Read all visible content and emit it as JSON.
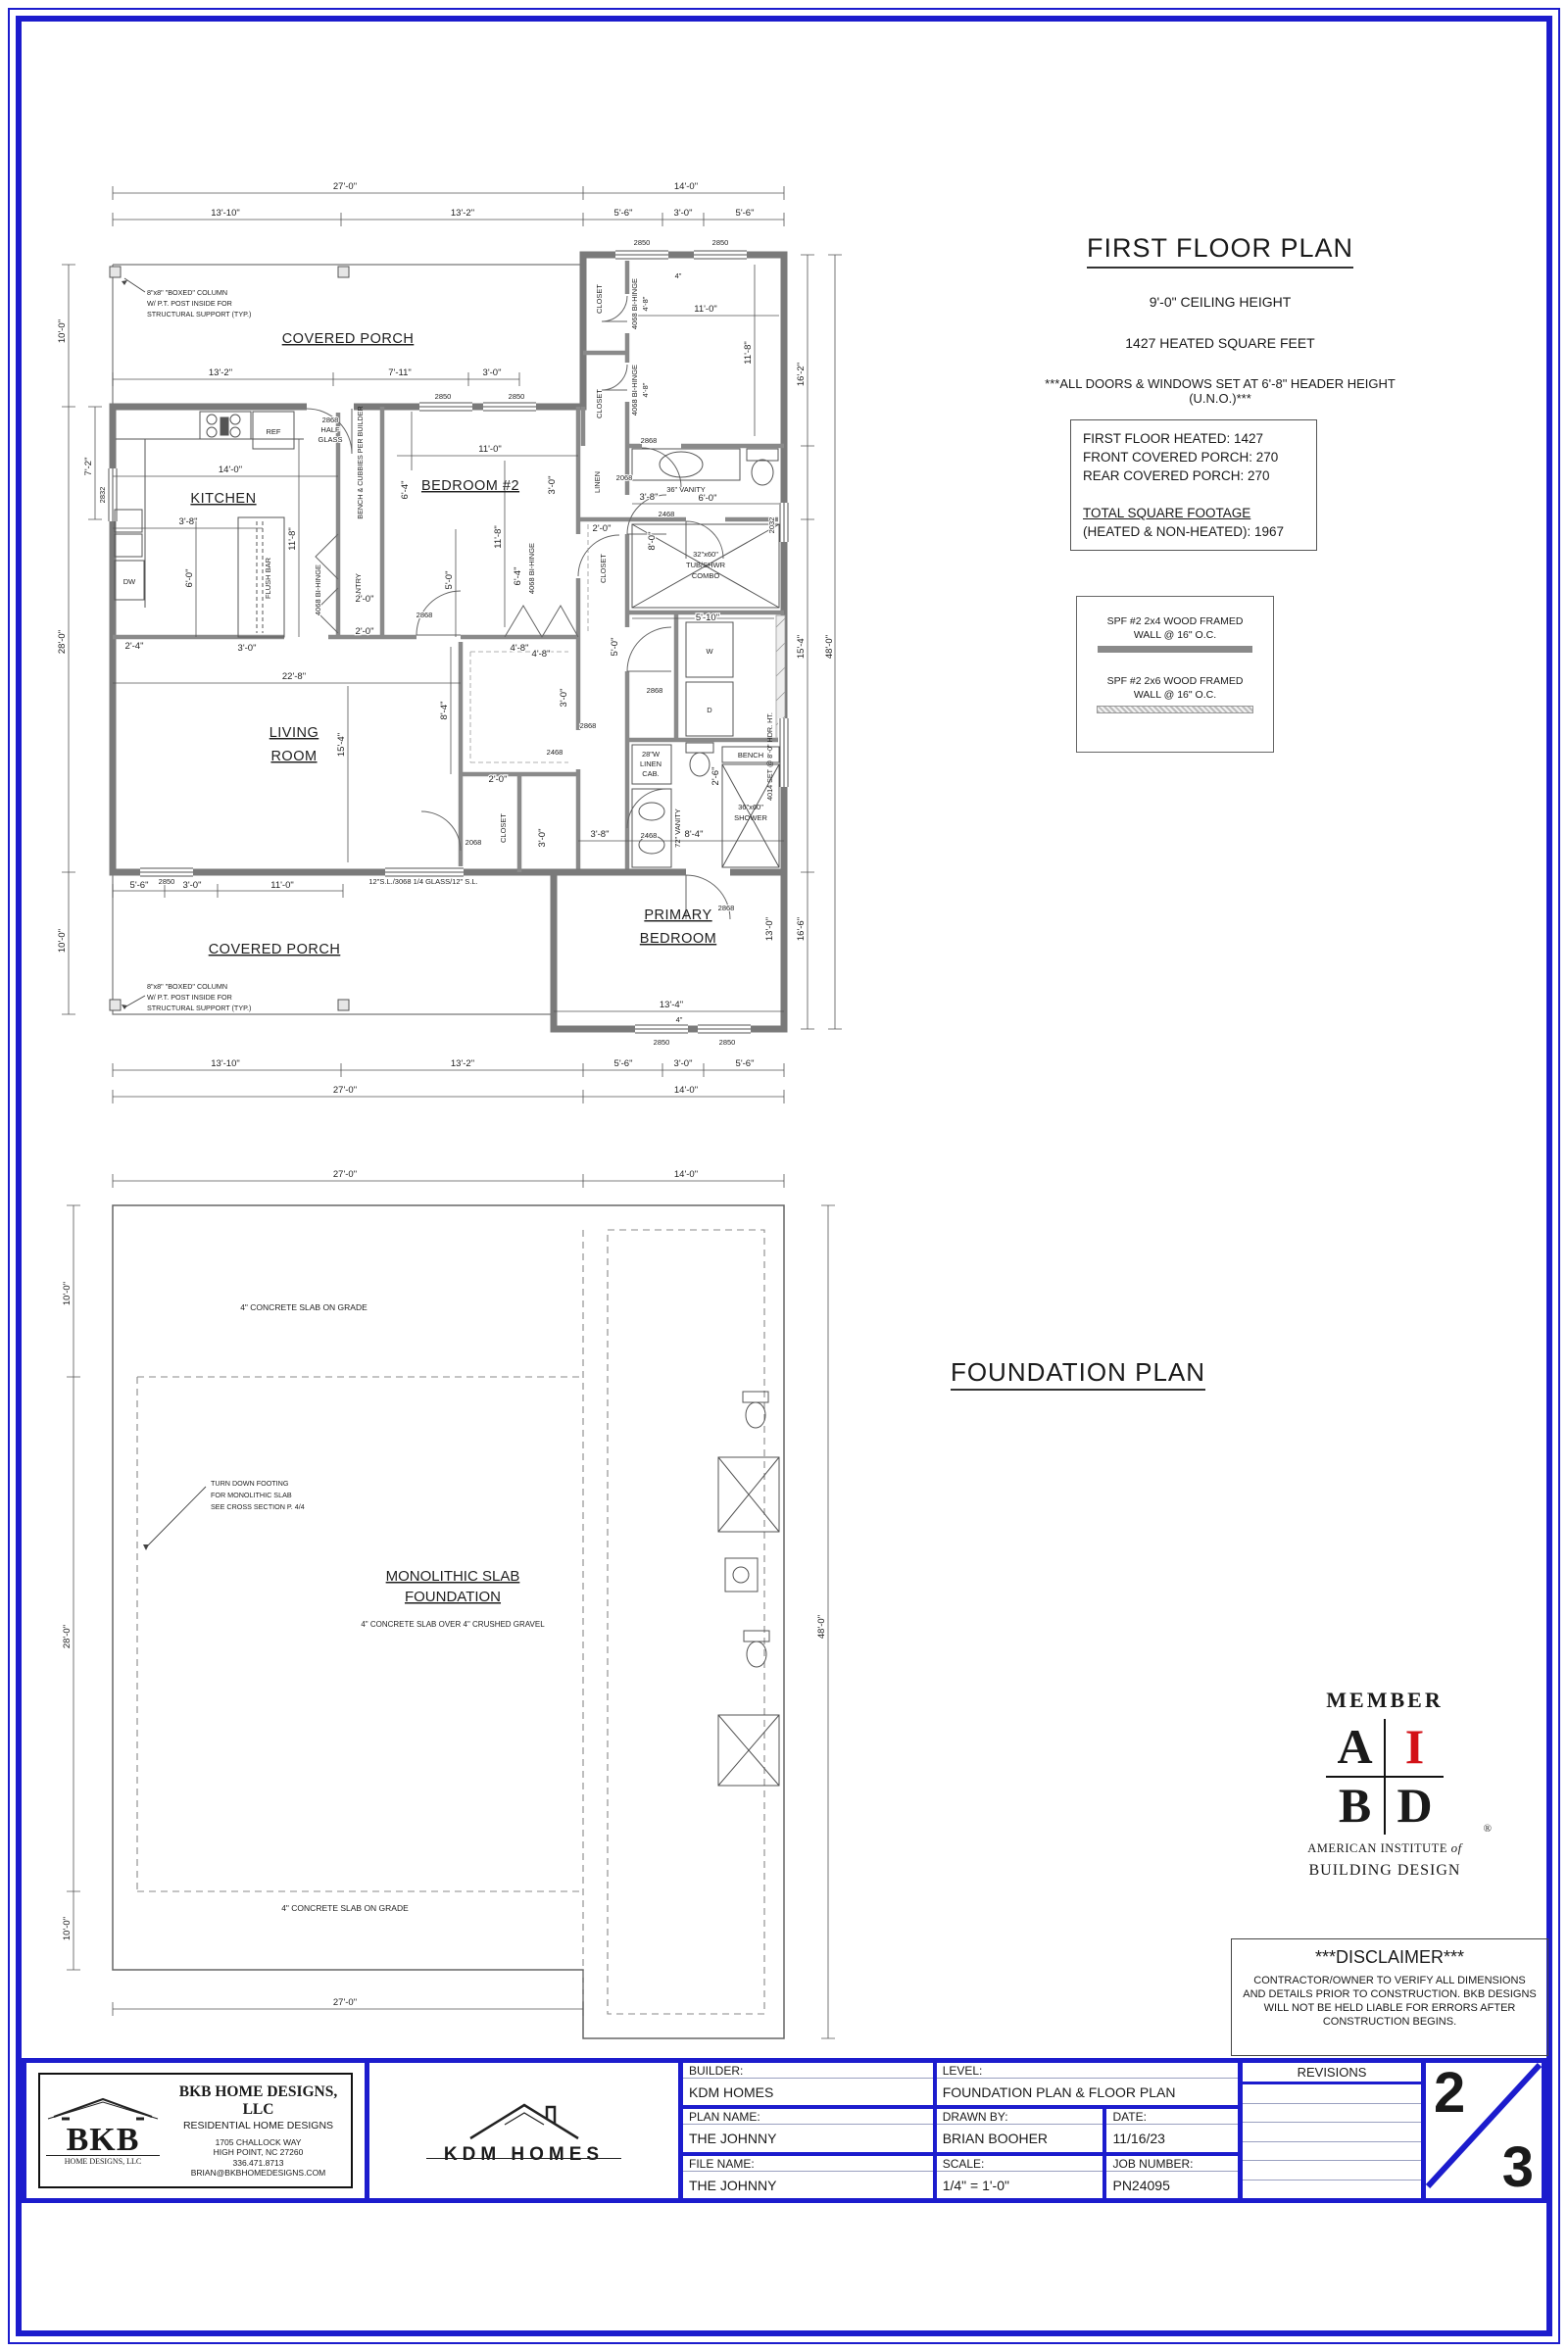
{
  "colors": {
    "border_blue": "#1c1ccd",
    "aibd_red": "#d31117",
    "wall_gray": "#7a7a7a"
  },
  "dims": {
    "d4": "4\"",
    "d2_0": "2'-0\"",
    "d2_4": "2'-4\"",
    "d2_6": "2'-6\"",
    "d3_0": "3'-0\"",
    "d3_8": "3'-8\"",
    "d4_8": "4'-8\"",
    "d5_0": "5'-0\"",
    "d5_6": "5'-6\"",
    "d5_10": "5'-10\"",
    "d6_0": "6'-0\"",
    "d6_4": "6'-4\"",
    "d7_2": "7'-2\"",
    "d7_11": "7'-11\"",
    "d8_0": "8'-0\"",
    "d8_4": "8'-4\"",
    "d10_0": "10'-0\"",
    "d11_0": "11'-0\"",
    "d11_8": "11'-8\"",
    "d13_0": "13'-0\"",
    "d13_2": "13'-2\"",
    "d13_4": "13'-4\"",
    "d13_10": "13'-10\"",
    "d14_0": "14'-0\"",
    "d15_4": "15'-4\"",
    "d16_2": "16'-2\"",
    "d16_6": "16'-6\"",
    "d22_8": "22'-8\"",
    "d27_0": "27'-0\"",
    "d28_0": "28'-0\"",
    "d48_0": "48'-0\""
  },
  "tags": {
    "w2850": "2850",
    "w2832": "2832",
    "w2032": "2032",
    "d2868": "2868",
    "d2068": "2068",
    "d2468": "2468",
    "bihinge": "4068 BI-HINGE",
    "hg1": "2868",
    "hg2": "HALF",
    "hg3": "GLASS",
    "slider": "12\"S.L./3068 1/4 GLASS/12\" S.L.",
    "w4014": "4014 SET @ 8'-0\" HDR. HT."
  },
  "rooms": {
    "covered_porch": "COVERED PORCH",
    "kitchen": "KITCHEN",
    "bedroom2": "BEDROOM #2",
    "living1": "LIVING",
    "living2": "ROOM",
    "primary1": "PRIMARY",
    "primary2": "BEDROOM"
  },
  "fx": {
    "ref": "REF",
    "dw": "DW",
    "flush": "FLUSH BAR",
    "pantry": "PANTRY",
    "linen": "LINEN",
    "closet": "CLOSET",
    "bench_cub": "BENCH & CUBBIES PER BUILDER",
    "v36": "36\" VANITY",
    "v72": "72\" VANITY",
    "tub1": "32\"x60\"",
    "tub2": "TUB/SHWR",
    "tub3": "COMBO",
    "sh1": "36\"x60\"",
    "sh2": "SHOWER",
    "bench": "BENCH",
    "lc1": "28\"W",
    "lc2": "LINEN",
    "lc3": "CAB.",
    "w": "W",
    "d": "D"
  },
  "notes": {
    "col1": "8\"x8\" \"BOXED\" COLUMN",
    "col2": "W/ P.T. POST INSIDE FOR",
    "col3": "STRUCTURAL SUPPORT (TYP.)"
  },
  "ffh": {
    "title": "FIRST FLOOR PLAN",
    "ceiling": "9'-0\" CEILING HEIGHT",
    "sqft": "1427 HEATED SQUARE FEET",
    "header": "***ALL DOORS & WINDOWS SET AT 6'-8\" HEADER HEIGHT (U.N.O.)***",
    "a1": "FIRST FLOOR HEATED: 1427",
    "a2": "FRONT COVERED PORCH: 270",
    "a3": "REAR COVERED PORCH: 270",
    "t1": "TOTAL SQUARE FOOTAGE",
    "t2": "(HEATED & NON-HEATED): 1967",
    "l1a": "SPF #2 2x4 WOOD FRAMED",
    "l1b": "WALL @ 16\" O.C.",
    "l2a": "SPF #2 2x6 WOOD FRAMED",
    "l2b": "WALL @ 16\" O.C."
  },
  "fp": {
    "heading": "FOUNDATION PLAN",
    "m1": "MONOLITHIC SLAB",
    "m2": "FOUNDATION",
    "m3": "4\" CONCRETE SLAB OVER 4\" CRUSHED GRAVEL",
    "slab": "4\" CONCRETE SLAB ON GRADE",
    "t1": "TURN DOWN FOOTING",
    "t2": "FOR MONOLITHIC SLAB",
    "t3": "SEE CROSS SECTION P. 4/4"
  },
  "aibd": {
    "member": "MEMBER",
    "a": "A",
    "i": "I",
    "b": "B",
    "d": "D",
    "reg": "®",
    "inst1": "AMERICAN INSTITUTE",
    "of": "of",
    "inst2": "BUILDING DESIGN"
  },
  "disc": {
    "title": "***DISCLAIMER***",
    "body": "CONTRACTOR/OWNER TO VERIFY ALL DIMENSIONS AND DETAILS PRIOR TO CONSTRUCTION. BKB DESIGNS WILL NOT BE HELD LIABLE FOR ERRORS AFTER CONSTRUCTION BEGINS."
  },
  "bkb": {
    "logo": "BKB",
    "logo_sub": "HOME DESIGNS, LLC",
    "name": "BKB HOME DESIGNS, LLC",
    "tag": "RESIDENTIAL HOME DESIGNS",
    "addr1": "1705 CHALLOCK WAY",
    "addr2": "HIGH POINT, NC 27260",
    "phone": "336.471.8713",
    "email": "BRIAN@BKBHOMEDESIGNS.COM"
  },
  "kdm": {
    "name": "KDM HOMES"
  },
  "tb": {
    "builder_l": "BUILDER:",
    "builder": "KDM HOMES",
    "level_l": "LEVEL:",
    "level": "FOUNDATION PLAN & FLOOR PLAN",
    "plan_l": "PLAN NAME:",
    "plan": "THE JOHNNY",
    "drawn_l": "DRAWN BY:",
    "drawn": "BRIAN BOOHER",
    "date_l": "DATE:",
    "date": "11/16/23",
    "file_l": "FILE NAME:",
    "file": "THE JOHNNY",
    "scale_l": "SCALE:",
    "scale": "1/4\" = 1'-0\"",
    "job_l": "JOB NUMBER:",
    "job": "PN24095",
    "rev": "REVISIONS",
    "sheet_top": "2",
    "sheet_bot": "3"
  }
}
